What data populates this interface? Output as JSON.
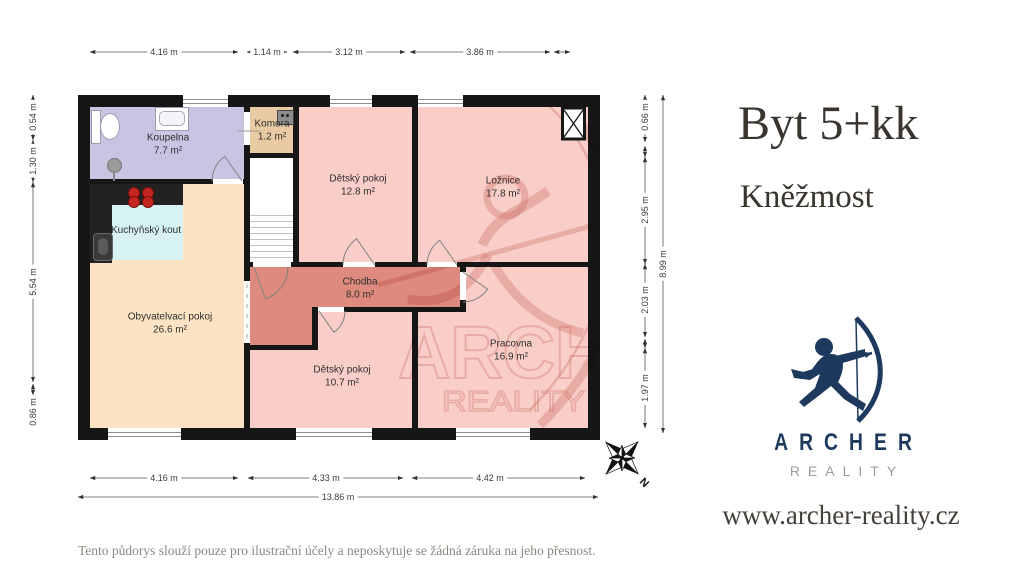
{
  "listing": {
    "title": "Byt 5+kk",
    "location": "Kněžmost"
  },
  "brand": {
    "name": "ARCHER",
    "tagline": "REALITY",
    "website": "www.archer-reality.cz",
    "navy": "#1d3a5e",
    "gray": "#9b9b9b"
  },
  "disclaimer": "Tento půdorys slouží pouze pro ilustrační účely a neposkytuje se žádná záruka na jeho přesnost.",
  "compass": {
    "north_label": "N"
  },
  "plan": {
    "rooms": [
      {
        "name": "Koupelna",
        "area": "7.7 m²",
        "color": "#c8c5e2"
      },
      {
        "name": "Komora",
        "area": "1.2 m²",
        "color": "#e8caa3"
      },
      {
        "name": "Dětský pokoj",
        "area": "12.8 m²",
        "color": "#f9cdc8"
      },
      {
        "name": "Ložnice",
        "area": "17.8 m²",
        "color": "#f9cdc8"
      },
      {
        "name": "Kuchyňský kout",
        "area": "",
        "color": "#d7f2f3"
      },
      {
        "name": "Obyvatelvací pokoj",
        "area": "26.6 m²",
        "color": "#fce3c3"
      },
      {
        "name": "Chodba",
        "area": "8.0 m²",
        "color": "#de8a7f"
      },
      {
        "name": "Dětský pokoj",
        "area": "10.7 m²",
        "color": "#f9cdc8"
      },
      {
        "name": "Pracovna",
        "area": "16.9 m²",
        "color": "#f9cdc8"
      }
    ],
    "wall_color": "#161616",
    "dimensions": {
      "top": [
        "4.16 m",
        "1.14 m",
        "3.12 m",
        "3.86 m"
      ],
      "bottom": [
        "4.16 m",
        "4.33 m",
        "4.42 m"
      ],
      "bottom_total": "13.86 m",
      "left": [
        "0.54 m",
        "1.30 m",
        "5.54 m",
        "0.86 m"
      ],
      "right": [
        "0.66 m",
        "2.95 m",
        "2.03 m",
        "1.97 m"
      ],
      "right_total": "8.99 m"
    }
  }
}
